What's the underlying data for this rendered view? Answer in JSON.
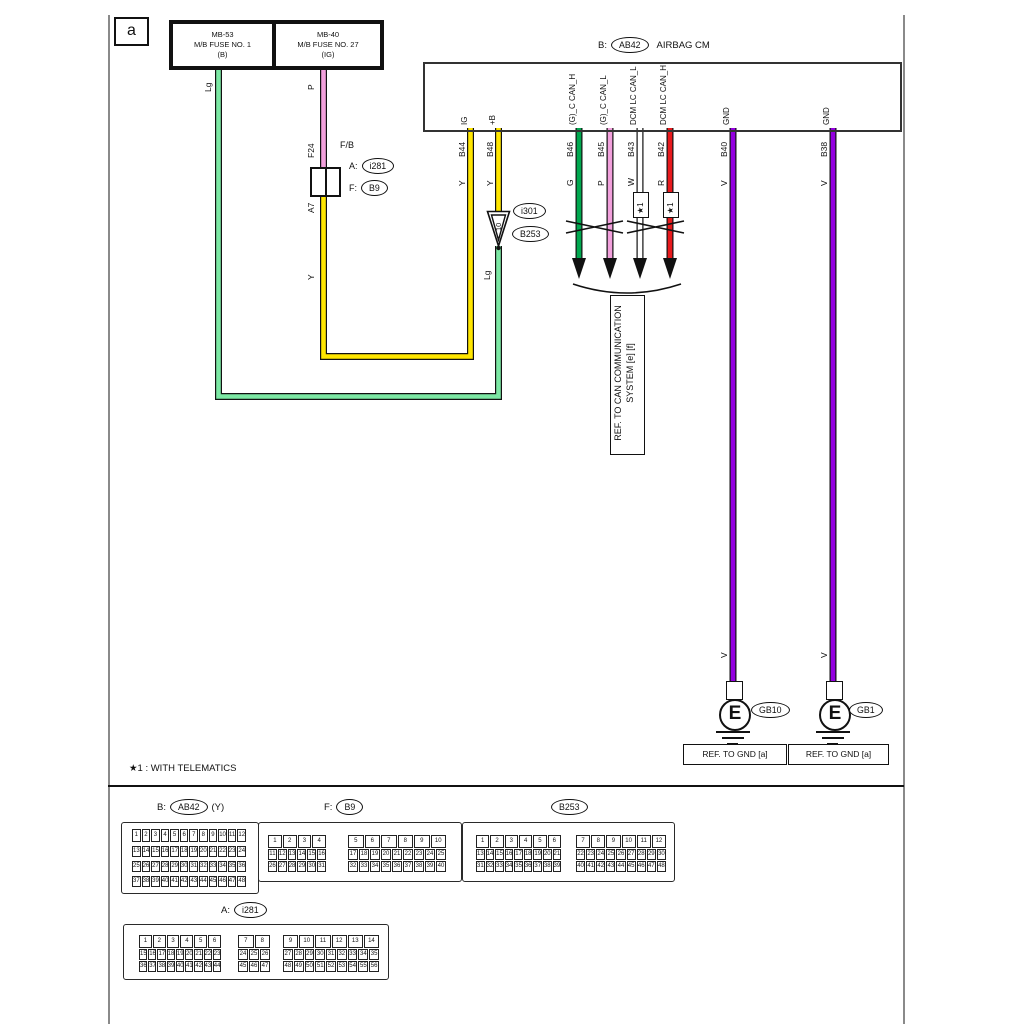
{
  "page": {
    "corner_label": "a",
    "note": "★1 : WITH TELEMATICS"
  },
  "colors": {
    "light_green": "#7CE8A4",
    "green": "#00A84F",
    "yellow": "#FFE600",
    "pink": "#F2A0DC",
    "red": "#E8191C",
    "violet": "#9400E0",
    "white": "#FFFFFF"
  },
  "fuses": [
    {
      "id": "MB-53",
      "name": "M/B FUSE NO. 1",
      "rating": "(B)"
    },
    {
      "id": "MB-40",
      "name": "M/B FUSE NO. 27",
      "rating": "(IG)"
    }
  ],
  "airbag_cm": {
    "prefix": "B:",
    "connector": "AB42",
    "title": "AIRBAG CM"
  },
  "fb_box": {
    "title": "F/B",
    "fuse_pin": "F24",
    "out_pin": "A7",
    "row_a_prefix": "A:",
    "row_a_ref": "i281",
    "row_f_prefix": "F:",
    "row_f_ref": "B9"
  },
  "joint": {
    "number": "10",
    "ref_top": "i301",
    "ref_bottom": "B253"
  },
  "wire_labels": {
    "mb53_color": "Lg",
    "mb40_color": "P",
    "fb_color": "Y",
    "joint_color": "Lg"
  },
  "pins": [
    {
      "pin": "B44",
      "signal": "IG",
      "color": "Y"
    },
    {
      "pin": "B48",
      "signal": "+B",
      "color": "Y"
    },
    {
      "pin": "B46",
      "signal": "(G)_C CAN_H",
      "color": "G"
    },
    {
      "pin": "B45",
      "signal": "(G)_C CAN_L",
      "color": "P"
    },
    {
      "pin": "B43",
      "signal": "DCM LC CAN_L",
      "color": "W",
      "note": "★1"
    },
    {
      "pin": "B42",
      "signal": "DCM LC CAN_H",
      "color": "R",
      "note": "★1"
    },
    {
      "pin": "B40",
      "signal": "GND",
      "color": "V",
      "color_lower": "V"
    },
    {
      "pin": "B38",
      "signal": "GND",
      "color": "V",
      "color_lower": "V"
    }
  ],
  "can_ref": {
    "line1": "REF. TO CAN COMMUNICATION",
    "line2": "SYSTEM [e] [f]"
  },
  "grounds": [
    {
      "symbol": "E",
      "ref": "GB10",
      "caption": "REF. TO GND [a]"
    },
    {
      "symbol": "E",
      "ref": "GB1",
      "caption": "REF. TO GND [a]"
    }
  ],
  "connectors": {
    "ab42": {
      "prefix": "B:",
      "ref": "AB42",
      "suffix": "(Y)",
      "blocks": [
        [
          [
            1,
            2,
            3,
            4,
            5,
            6,
            7,
            8,
            9,
            10,
            11,
            12
          ],
          [
            13,
            14,
            15,
            16,
            17,
            18,
            19,
            20,
            21,
            22,
            23,
            24
          ],
          [
            25,
            26,
            27,
            28,
            29,
            30,
            31,
            32,
            33,
            34,
            35,
            36
          ],
          [
            37,
            38,
            39,
            40,
            41,
            42,
            43,
            44,
            45,
            46,
            47,
            48
          ]
        ]
      ]
    },
    "b9": {
      "prefix": "F:",
      "ref": "B9",
      "blocks": [
        [
          [
            1,
            2,
            3,
            4
          ],
          [
            11,
            12,
            13,
            14,
            15,
            16
          ],
          [
            26,
            27,
            28,
            29,
            30,
            31
          ]
        ],
        [
          [
            5,
            6,
            7,
            8,
            9,
            10
          ],
          [
            17,
            18,
            19,
            20,
            21,
            22,
            23,
            24,
            25
          ],
          [
            32,
            33,
            34,
            35,
            36,
            37,
            38,
            39,
            40
          ]
        ]
      ]
    },
    "b253": {
      "ref": "B253",
      "blocks": [
        [
          [
            1,
            2,
            3,
            4,
            5,
            6
          ],
          [
            13,
            14,
            15,
            16,
            17,
            18,
            19,
            20,
            21
          ],
          [
            31,
            32,
            33,
            34,
            35,
            36,
            37,
            38,
            39
          ]
        ],
        [
          [
            7,
            8,
            9,
            10,
            11,
            12
          ],
          [
            22,
            23,
            24,
            25,
            26,
            27,
            28,
            29,
            30
          ],
          [
            40,
            41,
            42,
            43,
            44,
            45,
            46,
            47,
            48
          ]
        ]
      ]
    },
    "i281": {
      "prefix": "A:",
      "ref": "i281",
      "blocks": [
        [
          [
            1,
            2,
            3,
            4,
            5,
            6
          ],
          [
            15,
            16,
            17,
            18,
            19,
            20,
            21,
            22,
            23
          ],
          [
            36,
            37,
            38,
            39,
            40,
            41,
            42,
            43,
            44
          ]
        ],
        [
          [
            7,
            8
          ],
          [
            24,
            25,
            26
          ],
          [
            45,
            46,
            47
          ]
        ],
        [
          [
            9,
            10,
            11,
            12,
            13,
            14
          ],
          [
            27,
            28,
            29,
            30,
            31,
            32,
            33,
            34,
            35
          ],
          [
            48,
            49,
            50,
            51,
            52,
            53,
            54,
            55,
            56
          ]
        ]
      ]
    }
  }
}
